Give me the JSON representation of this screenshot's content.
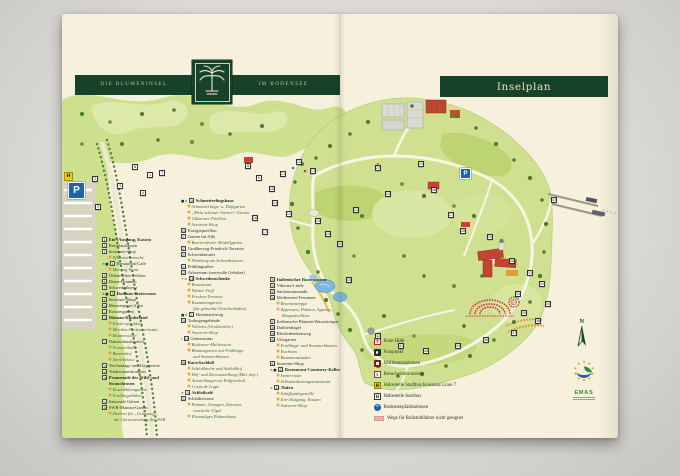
{
  "header": {
    "brand_left": "DIE BLUMENINSEL",
    "brand_right": "IM BODENSEE",
    "plan_title": "Inselplan"
  },
  "colors": {
    "brand_green": "#17422a",
    "paper": "#f6f0dc",
    "map_green": "#cfe190",
    "tree_green": "#4d7d31",
    "accent_red": "#c24531",
    "water_blue": "#7db7dc",
    "parking_blue": "#1f63b0",
    "bus_yellow": "#f2c51d",
    "rose_red": "#cc3a44"
  },
  "legend": {
    "col1": [
      {
        "n": "1",
        "label": "Ein-/Ausgang, Kassen",
        "t": "bold"
      },
      {
        "n": "2",
        "label": "Reisebuskassen"
      },
      {
        "n": "3",
        "label": "Souvenir-Shop"
      },
      {
        "label": "Pflanzenwünsche",
        "t": "sub"
      },
      {
        "n": "4",
        "label": "Restaurant/Café",
        "icons": "×■"
      },
      {
        "label": "Meeting Point",
        "t": "sub"
      },
      {
        "n": "5",
        "label": "Öffentliches Telefon"
      },
      {
        "n": "6",
        "label": "Diana-Brunnen"
      },
      {
        "n": "7",
        "label": "Schwedenkreuz"
      },
      {
        "n": "8",
        "label": "Rothaus-Seeterrasse",
        "t": "bold",
        "icons": "×■"
      },
      {
        "n": "9",
        "label": "Souvenir-Shop"
      },
      {
        "n": "10",
        "label": "Metasequoia-Allee"
      },
      {
        "n": "11",
        "label": "Kräutergarten"
      },
      {
        "n": "12",
        "label": "Mainau-Kinderland",
        "t": "bold"
      },
      {
        "label": "Kinderspielplatz",
        "t": "sub"
      },
      {
        "label": "Mörikes Gartenwerkstatt",
        "t": "sub"
      },
      {
        "label": "Blumenwiese",
        "t": "sub"
      },
      {
        "n": "13",
        "label": "Naturschutzbereich"
      },
      {
        "label": "Ponyreitbahn",
        "t": "sub"
      },
      {
        "label": "Bauernhof",
        "t": "sub"
      },
      {
        "label": "Streichelzoo",
        "t": "sub"
      },
      {
        "n": "14",
        "label": "Teichanlage und Liegewiese"
      },
      {
        "n": "15",
        "label": "Trinkwasserbrunnen"
      },
      {
        "n": "16",
        "label": "Promenade der Wild- und Strauchrosen",
        "t": "bold"
      },
      {
        "label": "Rosenblütengarten",
        "t": "sub"
      },
      {
        "label": "Frühlingsblüher",
        "t": "sub"
      },
      {
        "n": "17",
        "label": "Saisonale Gärten"
      },
      {
        "n": "18",
        "label": "SWR-Mainau-Garten"
      },
      {
        "label": "Drehort für „Grünzeug“,",
        "t": "sub"
      },
      {
        "label": "die Gartensendung des SWR",
        "t": "sub2"
      }
    ],
    "col2": [
      {
        "n": "19",
        "label": "Schmetterlingshaus",
        "t": "bold",
        "icons": "■×"
      },
      {
        "label": "Schmetterlings- u. Duftgarten",
        "t": "sub"
      },
      {
        "label": "„Mein schöner Garten“-Garten",
        "t": "sub"
      },
      {
        "label": "Gläserner Pavillon",
        "t": "sub"
      },
      {
        "label": "Souvenir-Shop",
        "t": "sub"
      },
      {
        "n": "20",
        "label": "Energiepavillon"
      },
      {
        "n": "21",
        "label": "Garten für Alle"
      },
      {
        "label": "Barrierefreier Modellgarten",
        "t": "sub"
      },
      {
        "n": "22",
        "label": "Großherzog-Friedrich-Terrasse"
      },
      {
        "n": "23",
        "label": "Schwedenturm"
      },
      {
        "label": "Weinberg am Schwedenturm",
        "t": "sub"
      },
      {
        "n": "24",
        "label": "Frühlingsallee"
      },
      {
        "n": "25",
        "label": "Arboretum (wertvolle Gehölze)"
      },
      {
        "n": "26",
        "label": "Schwedenschenke",
        "t": "bold",
        "icons": "+×"
      },
      {
        "label": "Restaurant",
        "t": "sub"
      },
      {
        "label": "Winzer-Treff",
        "t": "sub"
      },
      {
        "label": "Fresken-Terrasse",
        "t": "sub"
      },
      {
        "label": "Kastaniengarten",
        "t": "sub"
      },
      {
        "label": "(für gebuchte Gesellschaften)",
        "t": "sub2"
      },
      {
        "n": "27",
        "label": "Hortensienweg",
        "icons": "■×"
      },
      {
        "n": "28",
        "label": "Torbogengebäude"
      },
      {
        "label": "Volieren (Großsittiche)",
        "t": "sub"
      },
      {
        "label": "Souvenir-Shop",
        "t": "sub"
      },
      {
        "n": "29",
        "label": "Gärtnerturm",
        "icons": "i"
      },
      {
        "label": "Bodensee-Multivision",
        "t": "sub"
      },
      {
        "label": "Blumengarten mit Frühlings-",
        "t": "sub"
      },
      {
        "label": "und Sommerblumen",
        "t": "sub2"
      },
      {
        "n": "30",
        "label": "Barockschloß",
        "t": "bold"
      },
      {
        "label": "Schloßkirche und Schloßhof",
        "t": "sub"
      },
      {
        "label": "Hof- und Zierausstellung (Mai–Sep.)",
        "t": "sub"
      },
      {
        "label": "Ausstellungen im Erdgeschoß",
        "t": "sub"
      },
      {
        "label": "Corps de Logis",
        "t": "sub"
      },
      {
        "n": "31",
        "label": "Schloßcafé",
        "t": "bold",
        "icons": "×"
      },
      {
        "n": "32",
        "label": "Schloßterrasse"
      },
      {
        "label": "Palmen, Orangen, Zitronen,",
        "t": "sub"
      },
      {
        "label": "exotische Vögel",
        "t": "sub2"
      },
      {
        "label": "Ehemaliges Palmenhaus",
        "t": "sub"
      }
    ],
    "col3": [
      {
        "n": "33",
        "label": "Italienischer Rosengarten",
        "t": "bold"
      },
      {
        "n": "34",
        "label": "Viktoria-Linde"
      },
      {
        "n": "35",
        "label": "Säulensonnenuhr"
      },
      {
        "n": "36",
        "label": "Mediterran-Terrassen"
      },
      {
        "label": "Brunnentreppe",
        "t": "sub"
      },
      {
        "label": "Zypressen, Palmen, Agaven,",
        "t": "sub"
      },
      {
        "label": "Bougainvilleen",
        "t": "sub2"
      },
      {
        "n": "37",
        "label": "Italienische Blumen-Wassertreppe"
      },
      {
        "n": "38",
        "label": "Dahlienhügel"
      },
      {
        "n": "39",
        "label": "Rhododendronweg"
      },
      {
        "n": "40",
        "label": "Ufergarten"
      },
      {
        "label": "Frühlings- und Sommerblumen",
        "t": "sub"
      },
      {
        "label": "Fuchsien",
        "t": "sub"
      },
      {
        "label": "Bananenstauden",
        "t": "sub"
      },
      {
        "n": "41",
        "label": "Souvenir-Shop"
      },
      {
        "n": "42",
        "label": "Restaurant Comturey-Keller",
        "t": "bold",
        "icons": "×■"
      },
      {
        "label": "Seeterrasse",
        "t": "sub"
      },
      {
        "label": "Selbstbedienungsrestaurant",
        "t": "sub"
      },
      {
        "n": "43",
        "label": "Hafen",
        "t": "bold",
        "icons": "×"
      },
      {
        "label": "Schiffsanlegestelle",
        "t": "sub"
      },
      {
        "label": "Ein-/Ausgang, Kassen",
        "t": "sub"
      },
      {
        "label": "Souvenir-Shop",
        "t": "sub"
      }
    ]
  },
  "icon_legend": {
    "items": [
      {
        "icon": "cross",
        "label": "Erste Hilfe"
      },
      {
        "icon": "camera",
        "label": "Fotopunkt"
      },
      {
        "icon": "bin",
        "label": "Mülltrennstationen"
      },
      {
        "icon": "info",
        "label": "Besucherinformation"
      },
      {
        "icon": "bus7",
        "label": "Haltestelle Stadtbus Konstanz Linie 7"
      },
      {
        "icon": "busH",
        "label": "Haltestelle Inselbus"
      },
      {
        "icon": "wave",
        "label": "Bodenseepfadstationen"
      },
      {
        "icon": "pink",
        "label": "Wege für Rollstuhlfahrer nicht geeignet"
      }
    ]
  },
  "map": {
    "parking_main_label": "P",
    "parking_island_label": "P",
    "bus_stop_label": "H",
    "compass_label": "N",
    "emas_label": "EMAS",
    "markers": [
      {
        "n": "1",
        "x": 85,
        "y": 158
      },
      {
        "n": "2",
        "x": 30,
        "y": 162
      },
      {
        "n": "3",
        "x": 55,
        "y": 169
      },
      {
        "n": "4",
        "x": 78,
        "y": 176
      },
      {
        "n": "5",
        "x": 33,
        "y": 190
      },
      {
        "n": "6",
        "x": 70,
        "y": 150
      },
      {
        "n": "7",
        "x": 97,
        "y": 156
      },
      {
        "n": "8",
        "x": 183,
        "y": 149
      },
      {
        "n": "9",
        "x": 194,
        "y": 161
      },
      {
        "n": "10",
        "x": 207,
        "y": 172
      },
      {
        "n": "11",
        "x": 218,
        "y": 157
      },
      {
        "n": "12",
        "x": 234,
        "y": 145
      },
      {
        "n": "13",
        "x": 248,
        "y": 154
      },
      {
        "n": "14",
        "x": 210,
        "y": 186
      },
      {
        "n": "15",
        "x": 224,
        "y": 197
      },
      {
        "n": "16",
        "x": 190,
        "y": 201
      },
      {
        "n": "17",
        "x": 200,
        "y": 215
      },
      {
        "n": "18",
        "x": 284,
        "y": 263
      },
      {
        "n": "19",
        "x": 253,
        "y": 204
      },
      {
        "n": "20",
        "x": 263,
        "y": 217
      },
      {
        "n": "21",
        "x": 275,
        "y": 227
      },
      {
        "n": "22",
        "x": 291,
        "y": 193
      },
      {
        "n": "23",
        "x": 313,
        "y": 151
      },
      {
        "n": "24",
        "x": 323,
        "y": 177
      },
      {
        "n": "25",
        "x": 356,
        "y": 147
      },
      {
        "n": "26",
        "x": 369,
        "y": 173
      },
      {
        "n": "27",
        "x": 386,
        "y": 198
      },
      {
        "n": "28",
        "x": 398,
        "y": 214
      },
      {
        "n": "29",
        "x": 425,
        "y": 220
      },
      {
        "n": "30",
        "x": 447,
        "y": 244
      },
      {
        "n": "31",
        "x": 465,
        "y": 256
      },
      {
        "n": "32",
        "x": 477,
        "y": 267
      },
      {
        "n": "33",
        "x": 453,
        "y": 277
      },
      {
        "n": "34",
        "x": 483,
        "y": 287
      },
      {
        "n": "35",
        "x": 459,
        "y": 296
      },
      {
        "n": "36",
        "x": 473,
        "y": 304
      },
      {
        "n": "37",
        "x": 449,
        "y": 316
      },
      {
        "n": "38",
        "x": 421,
        "y": 323
      },
      {
        "n": "39",
        "x": 393,
        "y": 329
      },
      {
        "n": "40",
        "x": 361,
        "y": 334
      },
      {
        "n": "41",
        "x": 336,
        "y": 329
      },
      {
        "n": "42",
        "x": 313,
        "y": 319
      },
      {
        "n": "43",
        "x": 489,
        "y": 183
      }
    ]
  }
}
